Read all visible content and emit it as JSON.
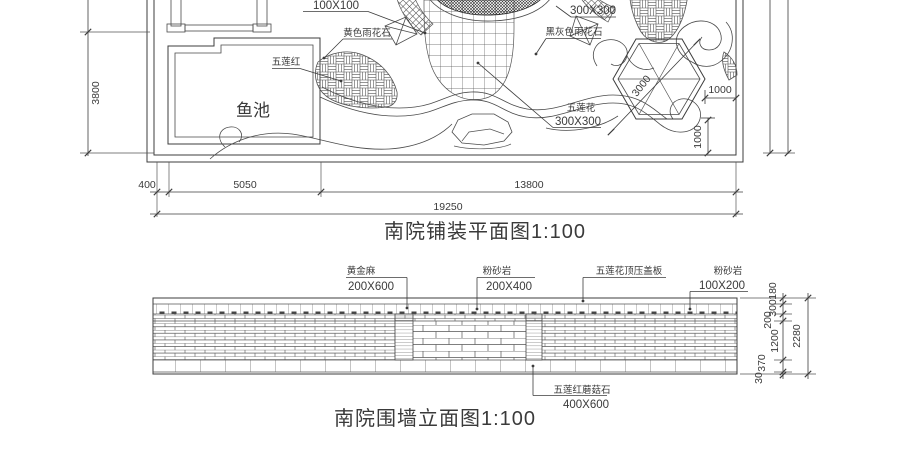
{
  "page": {
    "background": "#ffffff",
    "line_color": "#3c3c3c"
  },
  "plan": {
    "title": "南院铺装平面图1:100",
    "fish_pond_label": "鱼池",
    "labels": {
      "size_100x100": "100X100",
      "yellow_pebble": "黄色雨花石",
      "wulian_red": "五莲红",
      "dark_grey_pebble": "黑灰色雨花石",
      "size_300x300_top": "300X300",
      "wulian_flower": "五莲花",
      "wulian_flower_size": "300X300"
    },
    "dims": {
      "pond_height": "3800",
      "hex_width": "3000",
      "offset_right": "1000",
      "offset_bottom": "1000",
      "seg_400": "400",
      "seg_5050": "5050",
      "seg_13800": "13800",
      "total_19250": "19250"
    }
  },
  "elevation": {
    "title": "南院围墙立面图1:100",
    "callouts": [
      {
        "name": "黄金麻",
        "size": "200X600"
      },
      {
        "name": "粉砂岩",
        "size": "200X400"
      },
      {
        "name": "五莲花顶压盖板",
        "size": ""
      },
      {
        "name": "粉砂岩",
        "size": "100X200"
      },
      {
        "name": "五莲红蘑菇石",
        "size": "400X600"
      }
    ],
    "dims": {
      "band_180": "180",
      "band_300": "300",
      "band_200": "200",
      "band_1200": "1200",
      "band_370": "370",
      "band_30": "30",
      "total": "2280"
    }
  }
}
